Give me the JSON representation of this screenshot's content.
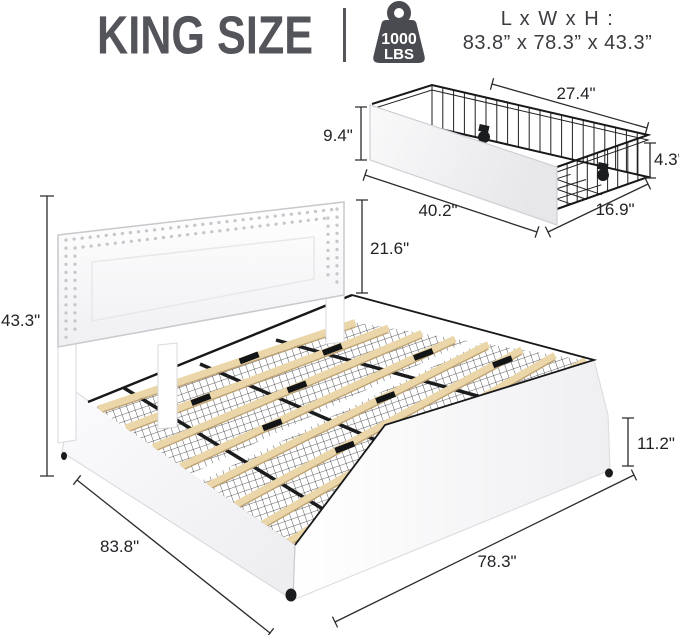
{
  "header": {
    "title": "KING SIZE",
    "weight_capacity": {
      "value": "1000",
      "unit": "LBS"
    },
    "dimensions_heading": "L x W x H :",
    "dimensions_value": "83.8” x 78.3” x 43.3”"
  },
  "drawer_diagram": {
    "description": "under-bed storage wire drawer with wheels",
    "labels": {
      "top_width": "27.4\"",
      "front_height": "9.4\"",
      "side_height": "4.3\"",
      "front_length": "40.2\"",
      "side_depth": "16.9\""
    }
  },
  "bed_diagram": {
    "description": "upholstered king bed frame with nailhead headboard, wood slats and storage baskets",
    "labels": {
      "headboard_panel_height": "21.6\"",
      "overall_height": "43.3\"",
      "base_height": "11.2\"",
      "overall_length": "83.8\"",
      "overall_width": "78.3\""
    }
  },
  "colors": {
    "title_gray": "#54555a",
    "icon_gray": "#4a4b50",
    "dimension_line": "#2c2c2e",
    "slat_wood": "#ead6a9",
    "frame_white": "#ffffff",
    "wire_black": "#1f2022"
  }
}
